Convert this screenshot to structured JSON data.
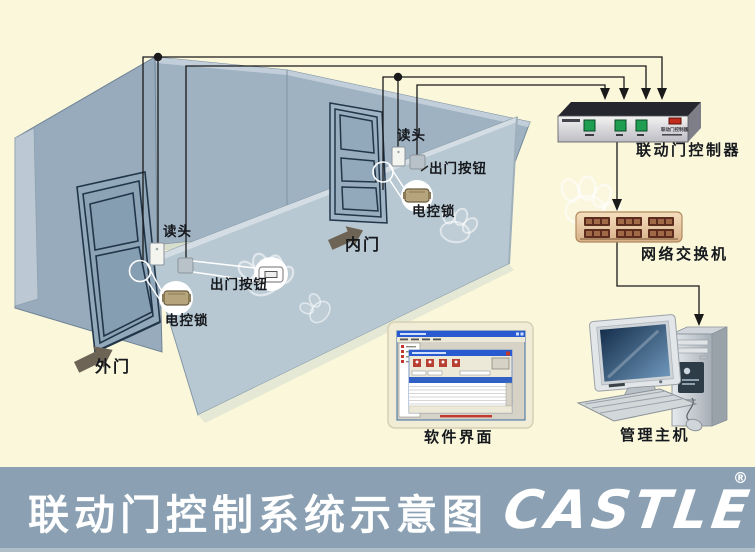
{
  "diagram": {
    "outer_door": {
      "door_label": "外门",
      "reader_label": "读头",
      "exit_button_label": "出门按钮",
      "lock_label": "电控锁"
    },
    "inner_door": {
      "door_label": "内门",
      "reader_label": "读头",
      "exit_button_label": "出门按钮",
      "lock_label": "电控锁"
    },
    "controller_label": "联动门控制器",
    "controller_nameplate": "联动门控制器",
    "switch_label": "网络交换机",
    "software_label": "软件界面",
    "host_label": "管理主机"
  },
  "footer": {
    "title": "联动门控制系统示意图",
    "logo": "CASTLE",
    "registered": "®"
  },
  "colors": {
    "background": "#FAF7DB",
    "footer_bar": "#8BA1B3",
    "wall_far": "#97ABBC",
    "wall_back": "#9FB2C2",
    "wall_near": "#B7C8D2",
    "door_outline": "#22364A",
    "wire": "#1A1A1A",
    "controller_button_green": "#1F9E52",
    "controller_led_red": "#C22C1E",
    "switch_body_tan": "#EBD0AC",
    "switch_port_dark": "#5C2C1E",
    "lock_body": "#B5A47C",
    "label_text": "#15181C",
    "title_text": "#FFFFFF"
  }
}
